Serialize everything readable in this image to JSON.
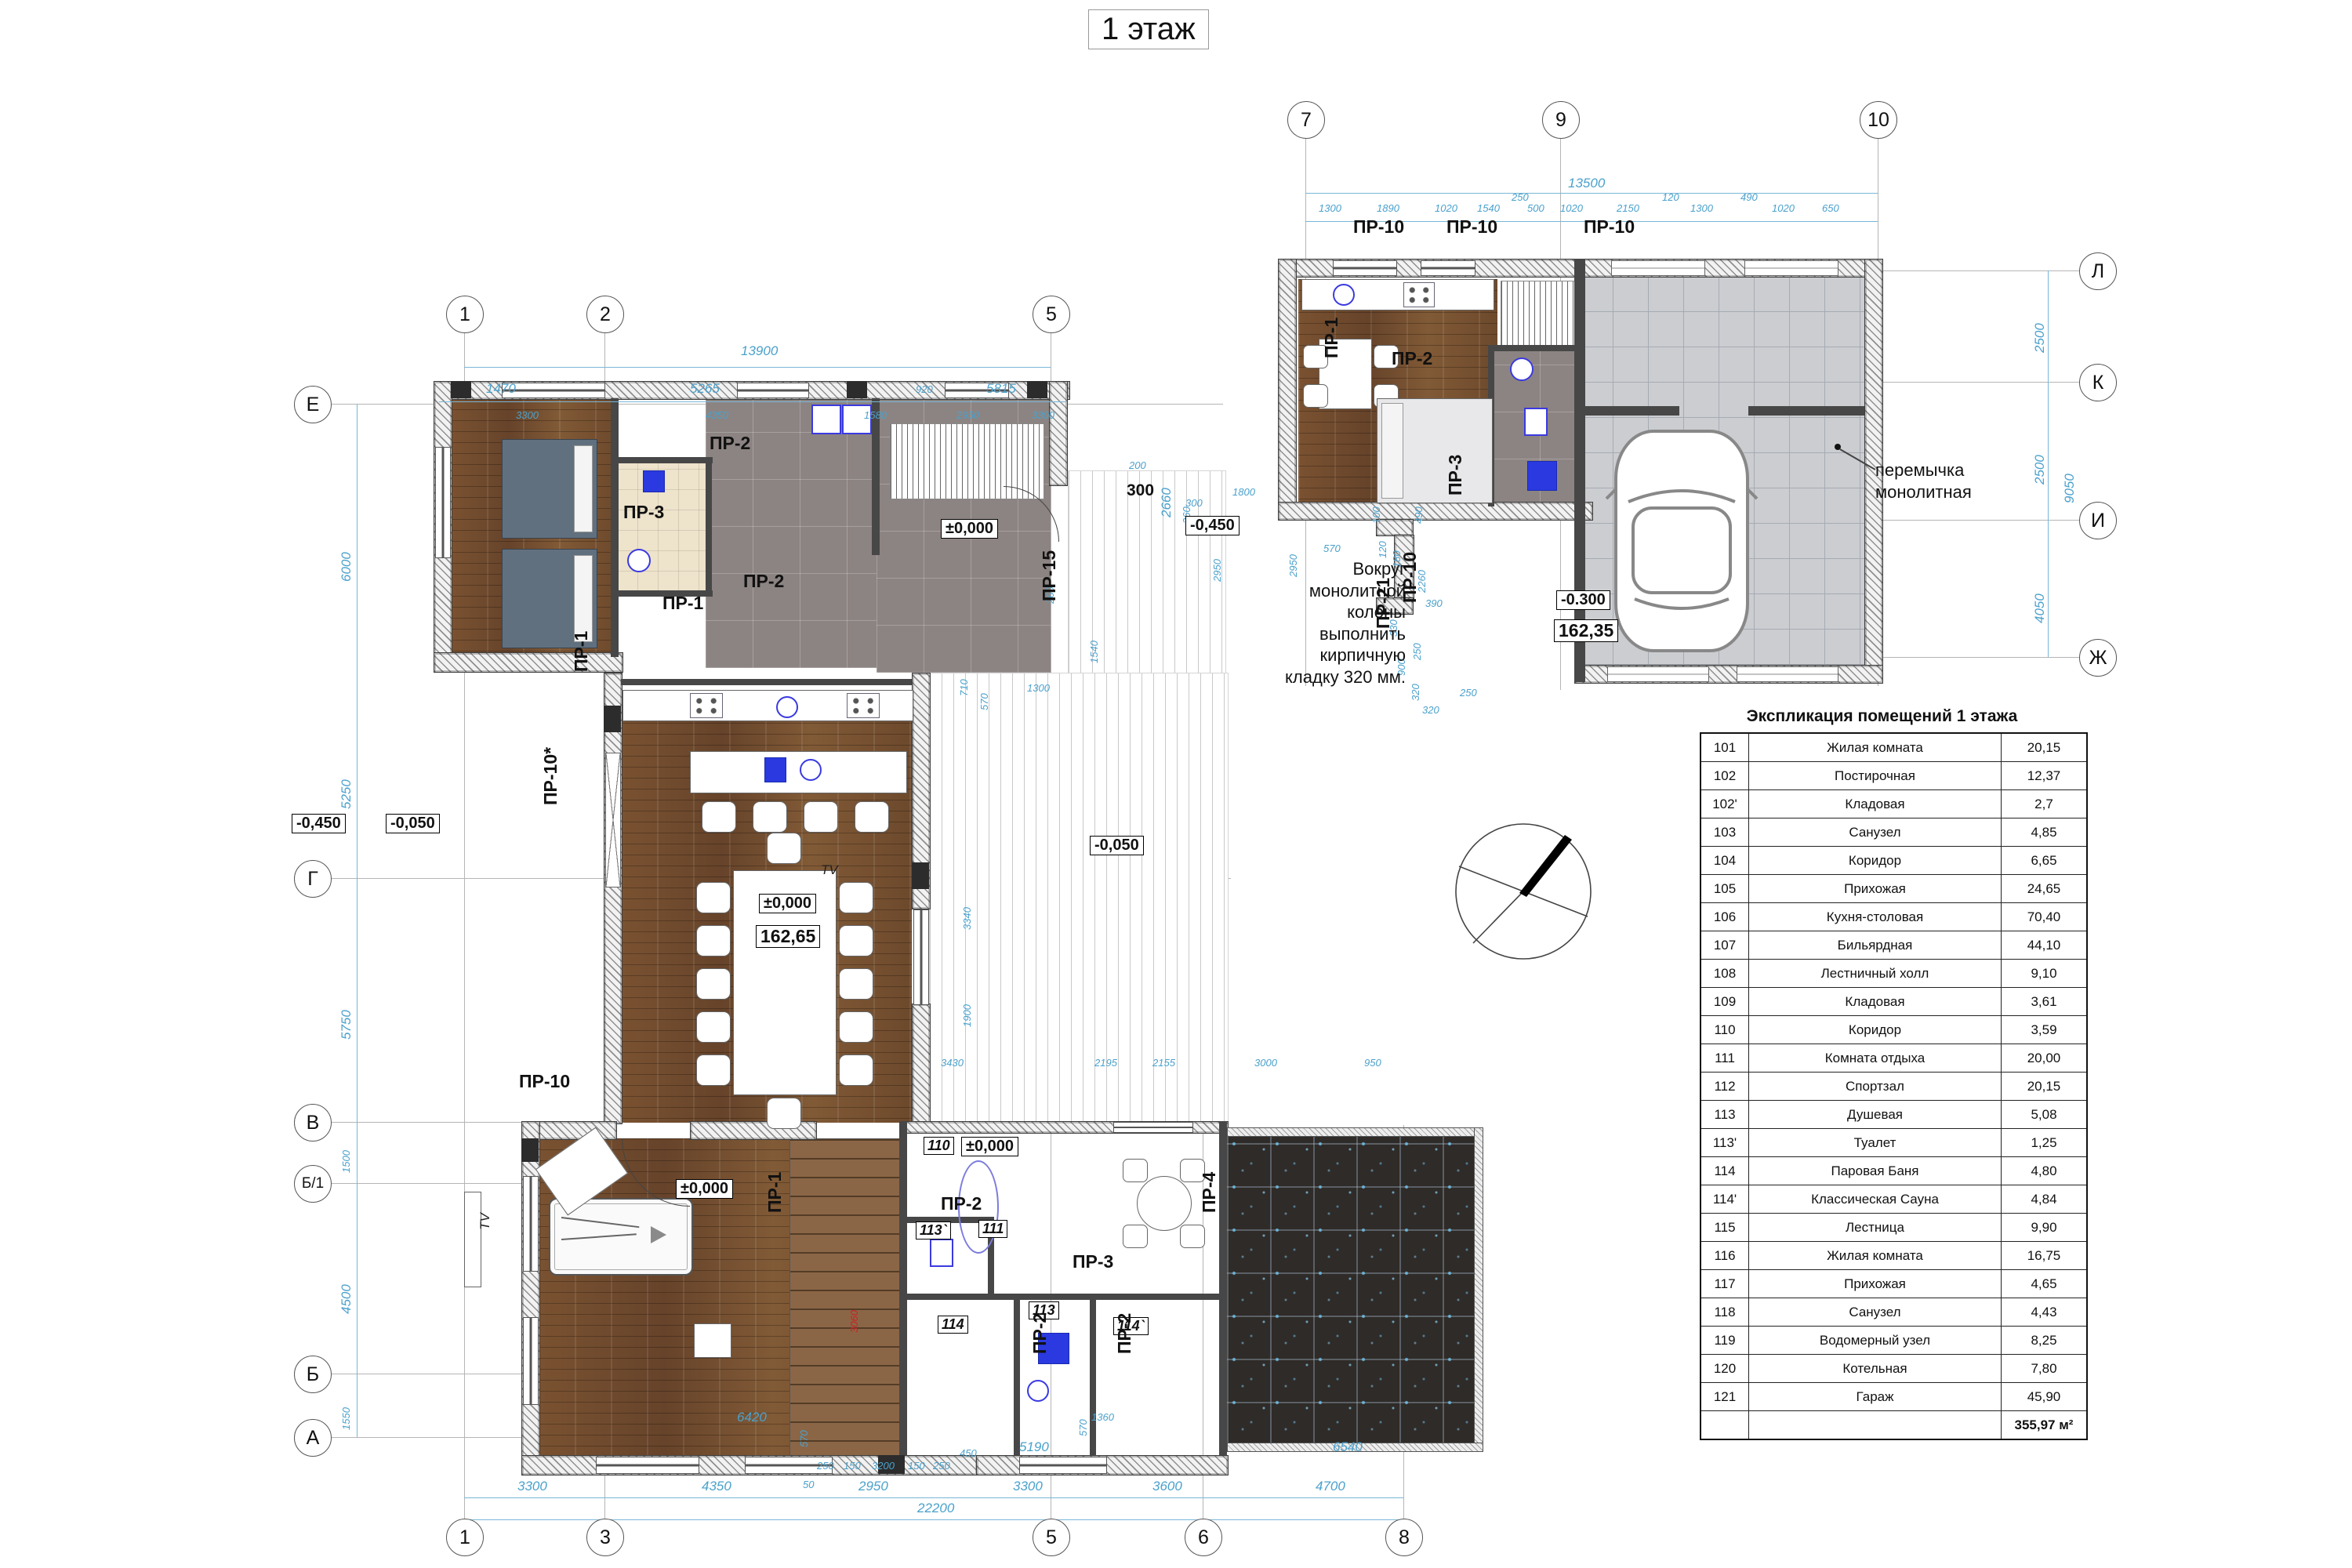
{
  "title": "1 этаж",
  "axes": {
    "top": [
      "1",
      "2",
      "5"
    ],
    "bottom": [
      "1",
      "3",
      "5",
      "6",
      "8"
    ],
    "left": [
      "Е",
      "Г",
      "В",
      "Б/1",
      "Б",
      "А"
    ],
    "garage_top": [
      "7",
      "9",
      "10"
    ],
    "garage_right": [
      "Л",
      "К",
      "И",
      "Ж"
    ]
  },
  "door_types": {
    "pr1": "ПР-1",
    "pr2": "ПР-2",
    "pr3": "ПР-3",
    "pr4": "ПР-4",
    "pr10": "ПР-10",
    "pr10s": "ПР-10*",
    "pr15": "ПР-15",
    "pr21": "ПР-21"
  },
  "room_tags": {
    "r110": "110",
    "r111": "111",
    "r113": "113",
    "r113p": "113`",
    "r114": "114",
    "r114p": "114`"
  },
  "elevations": {
    "entry_zero": "±0,000",
    "entry_300": "300",
    "entry_minus450": "-0,450",
    "left_minus450": "-0,450",
    "left_minus050": "-0,050",
    "mid_minus050": "-0,050",
    "kitchen_zero": "±0,000",
    "kitchen_area": "162,65",
    "billiard_zero": "±0,000",
    "hall_zero": "±0,000",
    "garage_minus300": "-0.300",
    "garage_area": "162,35"
  },
  "annotations": {
    "column_note": "Вокруг монолитной\nколоны\nвыполнить кирпичную\nкладку 320 мм.",
    "lintel_note": "перемычка\nмонолитная",
    "tv": "TV"
  },
  "dims": {
    "top": [
      "13900",
      "1470",
      "5265",
      "920",
      "5815",
      "3300",
      "4350",
      "1580",
      "2950",
      "3300"
    ],
    "left": [
      "6000",
      "5250",
      "5750",
      "1500",
      "4500",
      "1550"
    ],
    "bottom": [
      "6420",
      "1360",
      "570",
      "5190",
      "6540",
      "250",
      "150",
      "3200",
      "150",
      "250",
      "450",
      "50",
      "3300",
      "4350",
      "2950",
      "3300",
      "3600",
      "4700",
      "22200",
      "570"
    ],
    "right": [
      "2660",
      "200",
      "1800",
      "260",
      "2950",
      "2950",
      "300",
      "1540",
      "1300",
      "710",
      "570",
      "260"
    ],
    "mid": [
      "3430",
      "2195",
      "2155",
      "3000",
      "950",
      "3340",
      "1900",
      "3060"
    ],
    "garage_top": [
      "13500",
      "1300",
      "1890",
      "1020",
      "1540",
      "250",
      "500",
      "1020",
      "2150",
      "120",
      "1300",
      "490",
      "1020",
      "650"
    ],
    "garage_right": [
      "2500",
      "2500",
      "9050",
      "4050"
    ],
    "garage_inner": [
      "570",
      "100",
      "490",
      "120",
      "180",
      "2260",
      "390",
      "330",
      "900",
      "250",
      "320",
      "320",
      "250"
    ]
  },
  "legend": {
    "title": "Экспликация помещений 1 этажа",
    "rows": [
      {
        "num": "101",
        "name": "Жилая комната",
        "area": "20,15"
      },
      {
        "num": "102",
        "name": "Постирочная",
        "area": "12,37"
      },
      {
        "num": "102'",
        "name": "Кладовая",
        "area": "2,7"
      },
      {
        "num": "103",
        "name": "Санузел",
        "area": "4,85"
      },
      {
        "num": "104",
        "name": "Коридор",
        "area": "6,65"
      },
      {
        "num": "105",
        "name": "Прихожая",
        "area": "24,65"
      },
      {
        "num": "106",
        "name": "Кухня-столовая",
        "area": "70,40"
      },
      {
        "num": "107",
        "name": "Бильярдная",
        "area": "44,10"
      },
      {
        "num": "108",
        "name": "Лестничный холл",
        "area": "9,10"
      },
      {
        "num": "109",
        "name": "Кладовая",
        "area": "3,61"
      },
      {
        "num": "110",
        "name": "Коридор",
        "area": "3,59"
      },
      {
        "num": "111",
        "name": "Комната отдыха",
        "area": "20,00"
      },
      {
        "num": "112",
        "name": "Спортзал",
        "area": "20,15"
      },
      {
        "num": "113",
        "name": "Душевая",
        "area": "5,08"
      },
      {
        "num": "113'",
        "name": "Туалет",
        "area": "1,25"
      },
      {
        "num": "114",
        "name": "Паровая Баня",
        "area": "4,80"
      },
      {
        "num": "114'",
        "name": "Классическая Сауна",
        "area": "4,84"
      },
      {
        "num": "115",
        "name": "Лестница",
        "area": "9,90"
      },
      {
        "num": "116",
        "name": "Жилая комната",
        "area": "16,75"
      },
      {
        "num": "117",
        "name": "Прихожая",
        "area": "4,65"
      },
      {
        "num": "118",
        "name": "Санузел",
        "area": "4,43"
      },
      {
        "num": "119",
        "name": "Водомерный узел",
        "area": "8,25"
      },
      {
        "num": "120",
        "name": "Котельная",
        "area": "7,80"
      },
      {
        "num": "121",
        "name": "Гараж",
        "area": "45,90"
      }
    ],
    "total": "355,97 м²"
  }
}
